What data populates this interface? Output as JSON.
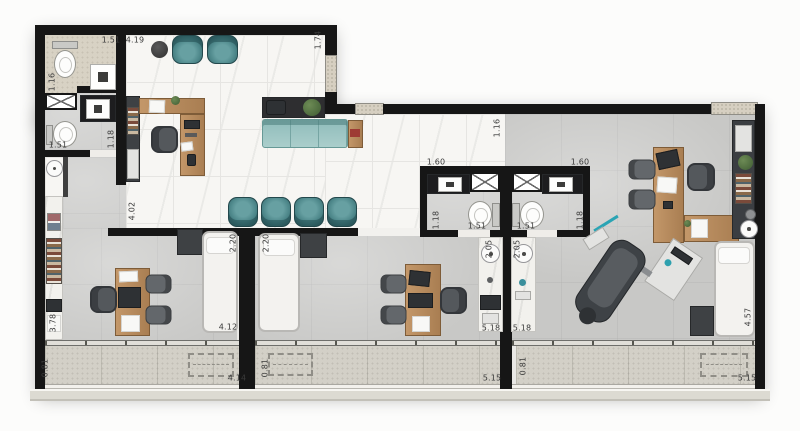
{
  "plan_title": "floor-plan",
  "colors": {
    "wall": "#161616",
    "partition": "#3f3f3f",
    "marble_floor": "#f7f6f3",
    "concrete_floor": "#c8c8c6",
    "sand_floor": "#d8d2c4",
    "balcony_floor": "#d3d0c7",
    "teal_chair": "#4c8689",
    "teal_sofa": "#9fc6c4",
    "wood": "#b98a5c",
    "stone_door": "#d6cfc1",
    "bed": "#f3f2ef",
    "dark_cabinet": "#3e4144"
  },
  "dimensions": [
    {
      "value": "1.51",
      "x": 111,
      "y": 40,
      "o": "h"
    },
    {
      "value": "4.19",
      "x": 135,
      "y": 40,
      "o": "h"
    },
    {
      "value": "1.74",
      "x": 318,
      "y": 40,
      "o": "v"
    },
    {
      "value": "1.16",
      "x": 52,
      "y": 82,
      "o": "v"
    },
    {
      "value": "1.18",
      "x": 111,
      "y": 139,
      "o": "v"
    },
    {
      "value": "1.51",
      "x": 58,
      "y": 145,
      "o": "h"
    },
    {
      "value": "4.02",
      "x": 132,
      "y": 211,
      "o": "v"
    },
    {
      "value": "1.16",
      "x": 497,
      "y": 128,
      "o": "v"
    },
    {
      "value": "1.60",
      "x": 436,
      "y": 162,
      "o": "h"
    },
    {
      "value": "1.60",
      "x": 580,
      "y": 162,
      "o": "h"
    },
    {
      "value": "1.18",
      "x": 436,
      "y": 220,
      "o": "v"
    },
    {
      "value": "1.51",
      "x": 477,
      "y": 226,
      "o": "h"
    },
    {
      "value": "1.51",
      "x": 526,
      "y": 226,
      "o": "h"
    },
    {
      "value": "1.18",
      "x": 580,
      "y": 220,
      "o": "v"
    },
    {
      "value": "2.05",
      "x": 489,
      "y": 249,
      "o": "v"
    },
    {
      "value": "2.05",
      "x": 517,
      "y": 249,
      "o": "v"
    },
    {
      "value": "2.20",
      "x": 233,
      "y": 243,
      "o": "v"
    },
    {
      "value": "2.20",
      "x": 266,
      "y": 243,
      "o": "v"
    },
    {
      "value": "4.12",
      "x": 228,
      "y": 327,
      "o": "h"
    },
    {
      "value": "3.78",
      "x": 53,
      "y": 323,
      "o": "v"
    },
    {
      "value": "0.81",
      "x": 45,
      "y": 368,
      "o": "v"
    },
    {
      "value": "4.14",
      "x": 237,
      "y": 378,
      "o": "h"
    },
    {
      "value": "0.81",
      "x": 265,
      "y": 368,
      "o": "v"
    },
    {
      "value": "5.15",
      "x": 492,
      "y": 378,
      "o": "h"
    },
    {
      "value": "0.81",
      "x": 523,
      "y": 366,
      "o": "v"
    },
    {
      "value": "5.18",
      "x": 491,
      "y": 328,
      "o": "h"
    },
    {
      "value": "5.18",
      "x": 522,
      "y": 328,
      "o": "h"
    },
    {
      "value": "4.57",
      "x": 748,
      "y": 317,
      "o": "v"
    },
    {
      "value": "5.15",
      "x": 747,
      "y": 378,
      "o": "h"
    }
  ]
}
